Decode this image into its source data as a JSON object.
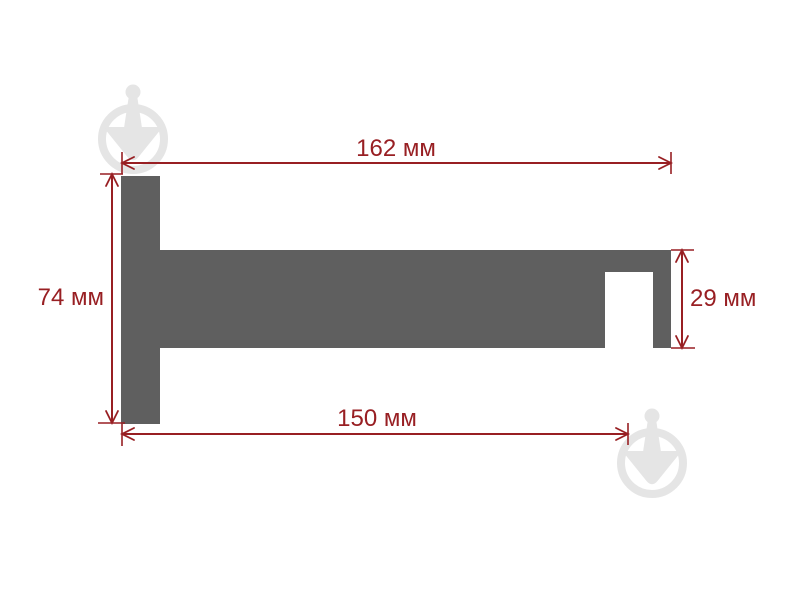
{
  "drawing": {
    "unit": "мм",
    "dimensions": {
      "top_width": {
        "value": "162",
        "label": "162 мм"
      },
      "left_height": {
        "value": "74",
        "label": "74 мм"
      },
      "bottom_width": {
        "value": "150",
        "label": "150 мм"
      },
      "right_height": {
        "value": "29",
        "label": "29 мм"
      }
    }
  },
  "watermark": {
    "icon": "trowel-in-circle-logo"
  },
  "colors": {
    "accent": "#981f23",
    "profile": "#5f5f5f",
    "watermark": "#e5e5e5",
    "background": "#ffffff"
  }
}
